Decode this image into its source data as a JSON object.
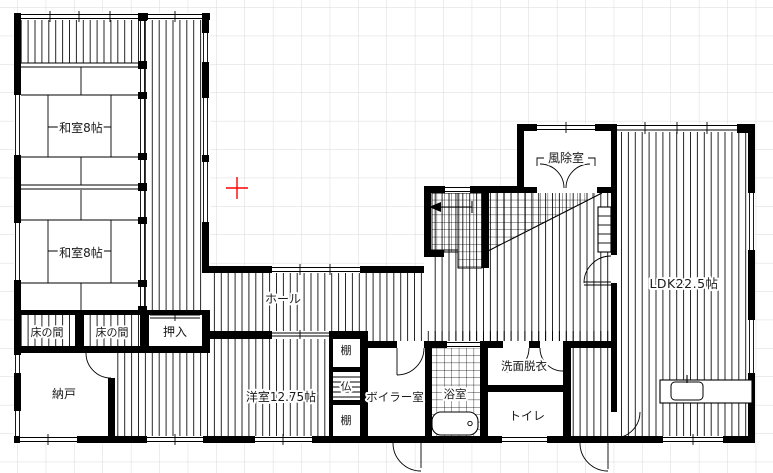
{
  "plan": {
    "title": "floor-plan",
    "rooms": {
      "washitsu1": {
        "label": "和室8帖"
      },
      "washitsu2": {
        "label": "和室8帖"
      },
      "tokonoma1": {
        "label": "床の間"
      },
      "tokonoma2": {
        "label": "床の間"
      },
      "oshiire": {
        "label": "押入"
      },
      "nando": {
        "label": "納戸"
      },
      "hall": {
        "label": "ホール"
      },
      "youshitsu": {
        "label": "洋室12.75帖"
      },
      "tana_top": {
        "label": "棚"
      },
      "butsudan": {
        "label": "仏"
      },
      "tana_bottom": {
        "label": "棚"
      },
      "boiler": {
        "label": "ボイラー室"
      },
      "bath": {
        "label": "浴室"
      },
      "senmen": {
        "label": "洗面脱衣"
      },
      "toilet": {
        "label": "トイレ"
      },
      "fujyoshitsu": {
        "label": "風除室"
      },
      "ldk": {
        "label": "LDK22.5帖"
      }
    },
    "colors": {
      "wall": "#000000",
      "grid": "#d9d9d9",
      "cursor_marker": "#ff0000",
      "background": "#ffffff"
    }
  }
}
